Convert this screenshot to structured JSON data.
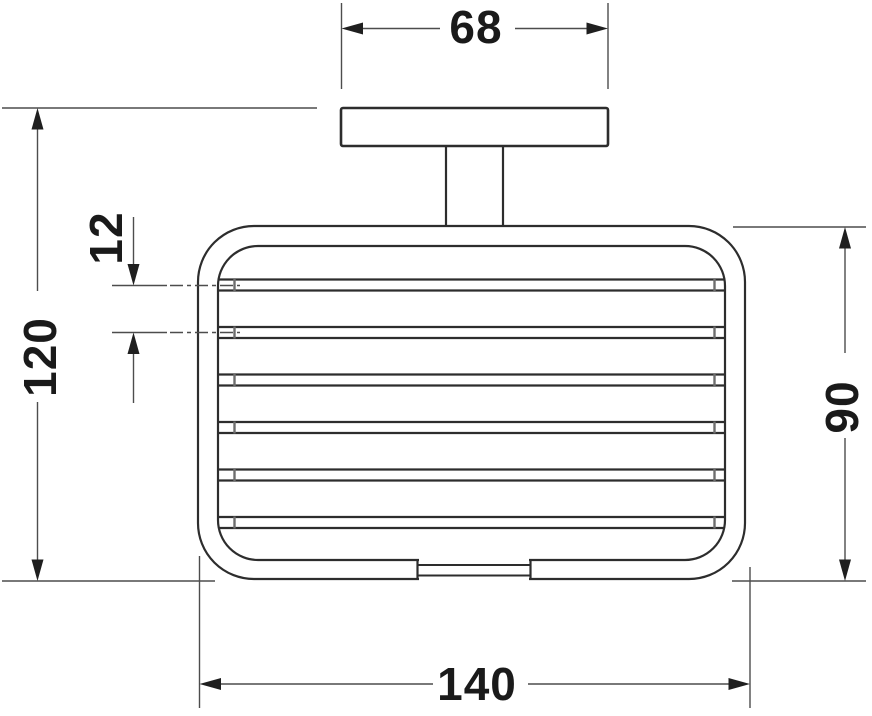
{
  "colors": {
    "background": "#ffffff",
    "object_line": "#2d2d2d",
    "dimension_line": "#4d4d4d",
    "tick_mark": "#6e6e6e",
    "arrow_fill": "#1f1f1f",
    "label_text": "#1a1a1a"
  },
  "drawing": {
    "dimensions": {
      "plate_width": {
        "value": "68"
      },
      "overall_height": {
        "value": "120"
      },
      "bar_spacing": {
        "value": "12"
      },
      "basket_height": {
        "value": "90"
      },
      "basket_width": {
        "value": "140"
      }
    },
    "parts": {
      "bar_count": 6
    }
  }
}
